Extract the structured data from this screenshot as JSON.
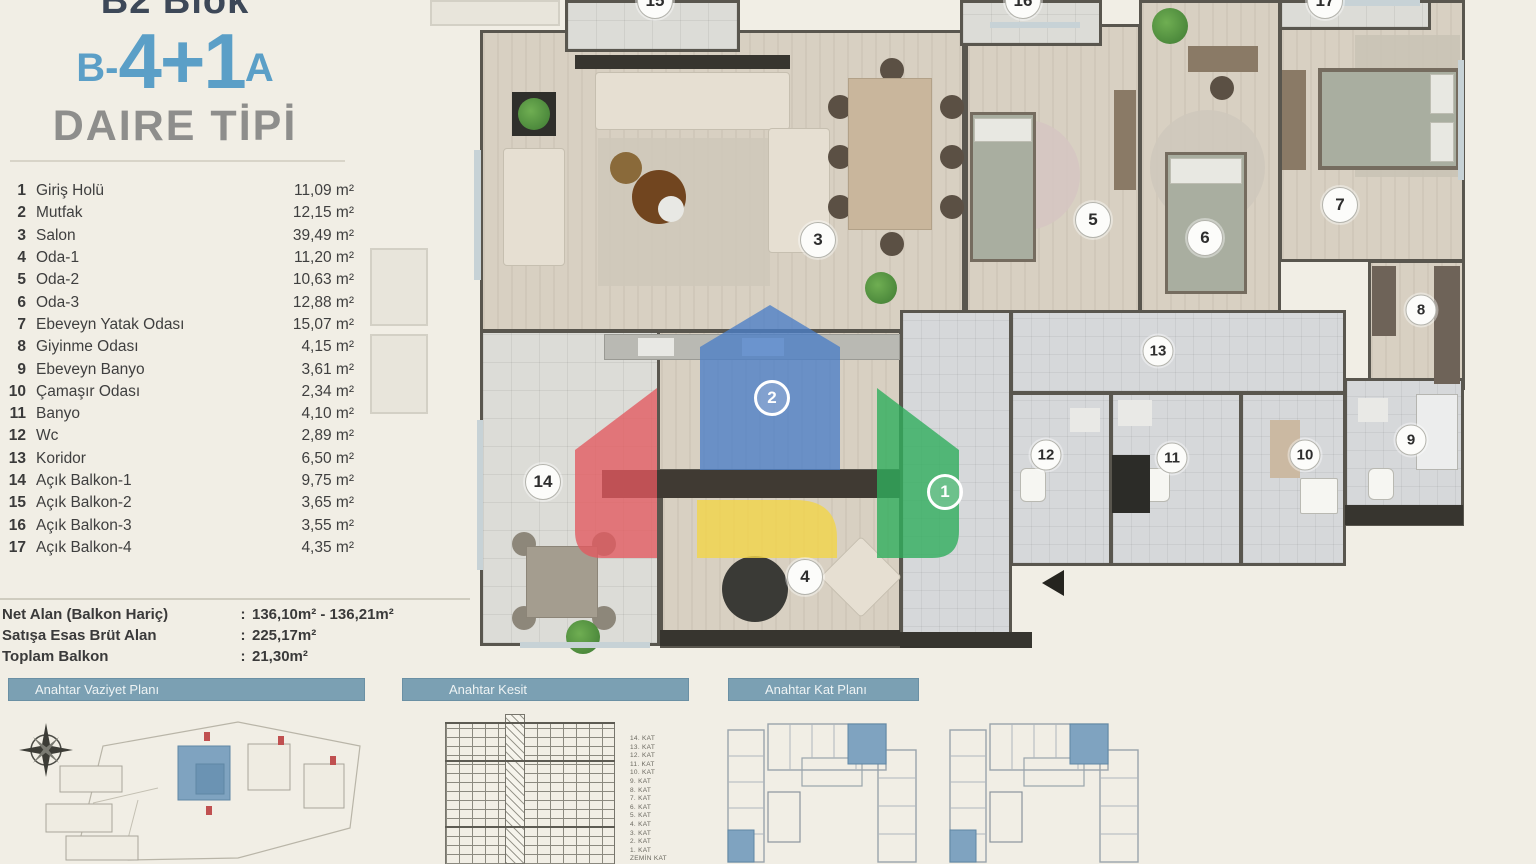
{
  "title": {
    "block": "B2 Blok",
    "code_prefix": "B-",
    "code_main": "4+1",
    "code_suffix": "A",
    "subtitle": "DAIRE TİPİ"
  },
  "room_list": [
    {
      "no": "1",
      "name": "Giriş Holü",
      "area": "11,09 m²"
    },
    {
      "no": "2",
      "name": "Mutfak",
      "area": "12,15 m²"
    },
    {
      "no": "3",
      "name": "Salon",
      "area": "39,49 m²"
    },
    {
      "no": "4",
      "name": "Oda-1",
      "area": "11,20 m²"
    },
    {
      "no": "5",
      "name": "Oda-2",
      "area": "10,63 m²"
    },
    {
      "no": "6",
      "name": "Oda-3",
      "area": "12,88 m²"
    },
    {
      "no": "7",
      "name": "Ebeveyn Yatak Odası",
      "area": "15,07 m²"
    },
    {
      "no": "8",
      "name": "Giyinme Odası",
      "area": "4,15 m²"
    },
    {
      "no": "9",
      "name": "Ebeveyn Banyo",
      "area": "3,61 m²"
    },
    {
      "no": "10",
      "name": "Çamaşır Odası",
      "area": "2,34 m²"
    },
    {
      "no": "11",
      "name": "Banyo",
      "area": "4,10 m²"
    },
    {
      "no": "12",
      "name": "Wc",
      "area": "2,89 m²"
    },
    {
      "no": "13",
      "name": "Koridor",
      "area": "6,50 m²"
    },
    {
      "no": "14",
      "name": "Açık Balkon-1",
      "area": "9,75 m²"
    },
    {
      "no": "15",
      "name": "Açık Balkon-2",
      "area": "3,65 m²"
    },
    {
      "no": "16",
      "name": "Açık Balkon-3",
      "area": "3,55 m²"
    },
    {
      "no": "17",
      "name": "Açık Balkon-4",
      "area": "4,35 m²"
    }
  ],
  "summary": [
    {
      "label": "Net Alan (Balkon Hariç)",
      "sep": ":",
      "value": "136,10m² - 136,21m²"
    },
    {
      "label": "Satışa Esas Brüt Alan",
      "sep": ":",
      "value": "225,17m²"
    },
    {
      "label": "Toplam Balkon",
      "sep": ":",
      "value": "21,30m²"
    }
  ],
  "sections": {
    "vaziyet": "Anahtar Vaziyet Planı",
    "kesit": "Anahtar Kesit",
    "kat": "Anahtar Kat Planı"
  },
  "kesit_floors": [
    "14. KAT",
    "13. KAT",
    "12. KAT",
    "11. KAT",
    "10. KAT",
    "9. KAT",
    "8. KAT",
    "7. KAT",
    "6. KAT",
    "5. KAT",
    "4. KAT",
    "3. KAT",
    "2. KAT",
    "1. KAT",
    "ZEMİN KAT"
  ],
  "plan_markers": [
    {
      "n": "1",
      "x": 575,
      "y": 492,
      "cls": "on-logo"
    },
    {
      "n": "2",
      "x": 402,
      "y": 398,
      "cls": "on-logo"
    },
    {
      "n": "3",
      "x": 448,
      "y": 240,
      "cls": ""
    },
    {
      "n": "4",
      "x": 435,
      "y": 577,
      "cls": ""
    },
    {
      "n": "5",
      "x": 723,
      "y": 220,
      "cls": ""
    },
    {
      "n": "6",
      "x": 835,
      "y": 238,
      "cls": ""
    },
    {
      "n": "7",
      "x": 970,
      "y": 205,
      "cls": ""
    },
    {
      "n": "8",
      "x": 1051,
      "y": 310,
      "cls": "sm"
    },
    {
      "n": "9",
      "x": 1041,
      "y": 440,
      "cls": "sm"
    },
    {
      "n": "10",
      "x": 935,
      "y": 455,
      "cls": "sm"
    },
    {
      "n": "11",
      "x": 802,
      "y": 458,
      "cls": "sm"
    },
    {
      "n": "12",
      "x": 676,
      "y": 455,
      "cls": "sm"
    },
    {
      "n": "13",
      "x": 788,
      "y": 351,
      "cls": "sm"
    },
    {
      "n": "14",
      "x": 173,
      "y": 482,
      "cls": ""
    },
    {
      "n": "15",
      "x": 285,
      "y": 1,
      "cls": "cut"
    },
    {
      "n": "16",
      "x": 653,
      "y": 1,
      "cls": "cut"
    },
    {
      "n": "17",
      "x": 955,
      "y": 1,
      "cls": "cut"
    }
  ],
  "colors": {
    "accent_blue": "#5b9fc7",
    "bar_blue": "#7ba0b3",
    "logo_blue": "#4a7ec7",
    "logo_red": "#e3595f",
    "logo_green": "#2fae5c",
    "logo_yellow": "#f2d44a",
    "highlight_unit": "#7fa3c0"
  }
}
